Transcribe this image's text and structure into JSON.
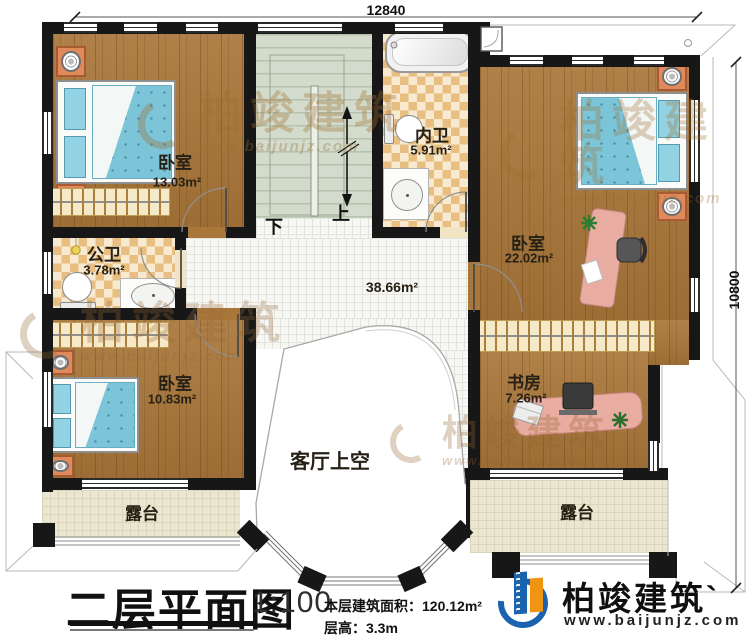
{
  "plan": {
    "dimensions": {
      "width": "12840",
      "height": "10800"
    },
    "titleblock": {
      "title": "二层平面图",
      "scale": "1:100",
      "floor_area": "本层建筑面积：120.12m²",
      "floor_height": "层高：3.3m"
    }
  },
  "rooms": [
    {
      "id": "bedroom-top-left",
      "name": "卧室",
      "area": "13.03m²"
    },
    {
      "id": "public-bath",
      "name": "公卫",
      "area": "3.78m²"
    },
    {
      "id": "ensuite-bath",
      "name": "内卫",
      "area": "5.91m²"
    },
    {
      "id": "bedroom-right",
      "name": "卧室",
      "area": "22.02m²"
    },
    {
      "id": "bedroom-bottom-left",
      "name": "卧室",
      "area": "10.83m²"
    },
    {
      "id": "study",
      "name": "书房",
      "area": "7.26m²"
    },
    {
      "id": "terrace-left",
      "name": "露台"
    },
    {
      "id": "terrace-right",
      "name": "露台"
    }
  ],
  "hall": {
    "area": "38.66m²",
    "void_label": "客厅上空"
  },
  "stairs": {
    "down": "下",
    "up": "上"
  },
  "brand": {
    "watermark_name": "柏竣建筑",
    "watermark_url": "www.baijunjz.com",
    "logo_name": "柏竣建筑`",
    "logo_url": "www.baijunjz.com"
  },
  "colors": {
    "wall": "#171717",
    "wood": "#a9773a",
    "bath_tile": "#e8bf80",
    "stair": "#d2dbcc",
    "terrace": "#ebe6d1",
    "bed": "#7cc4d8",
    "desk": "#e9aca1",
    "logo_blue": "#1b63ae",
    "logo_orange": "#ef9413"
  }
}
